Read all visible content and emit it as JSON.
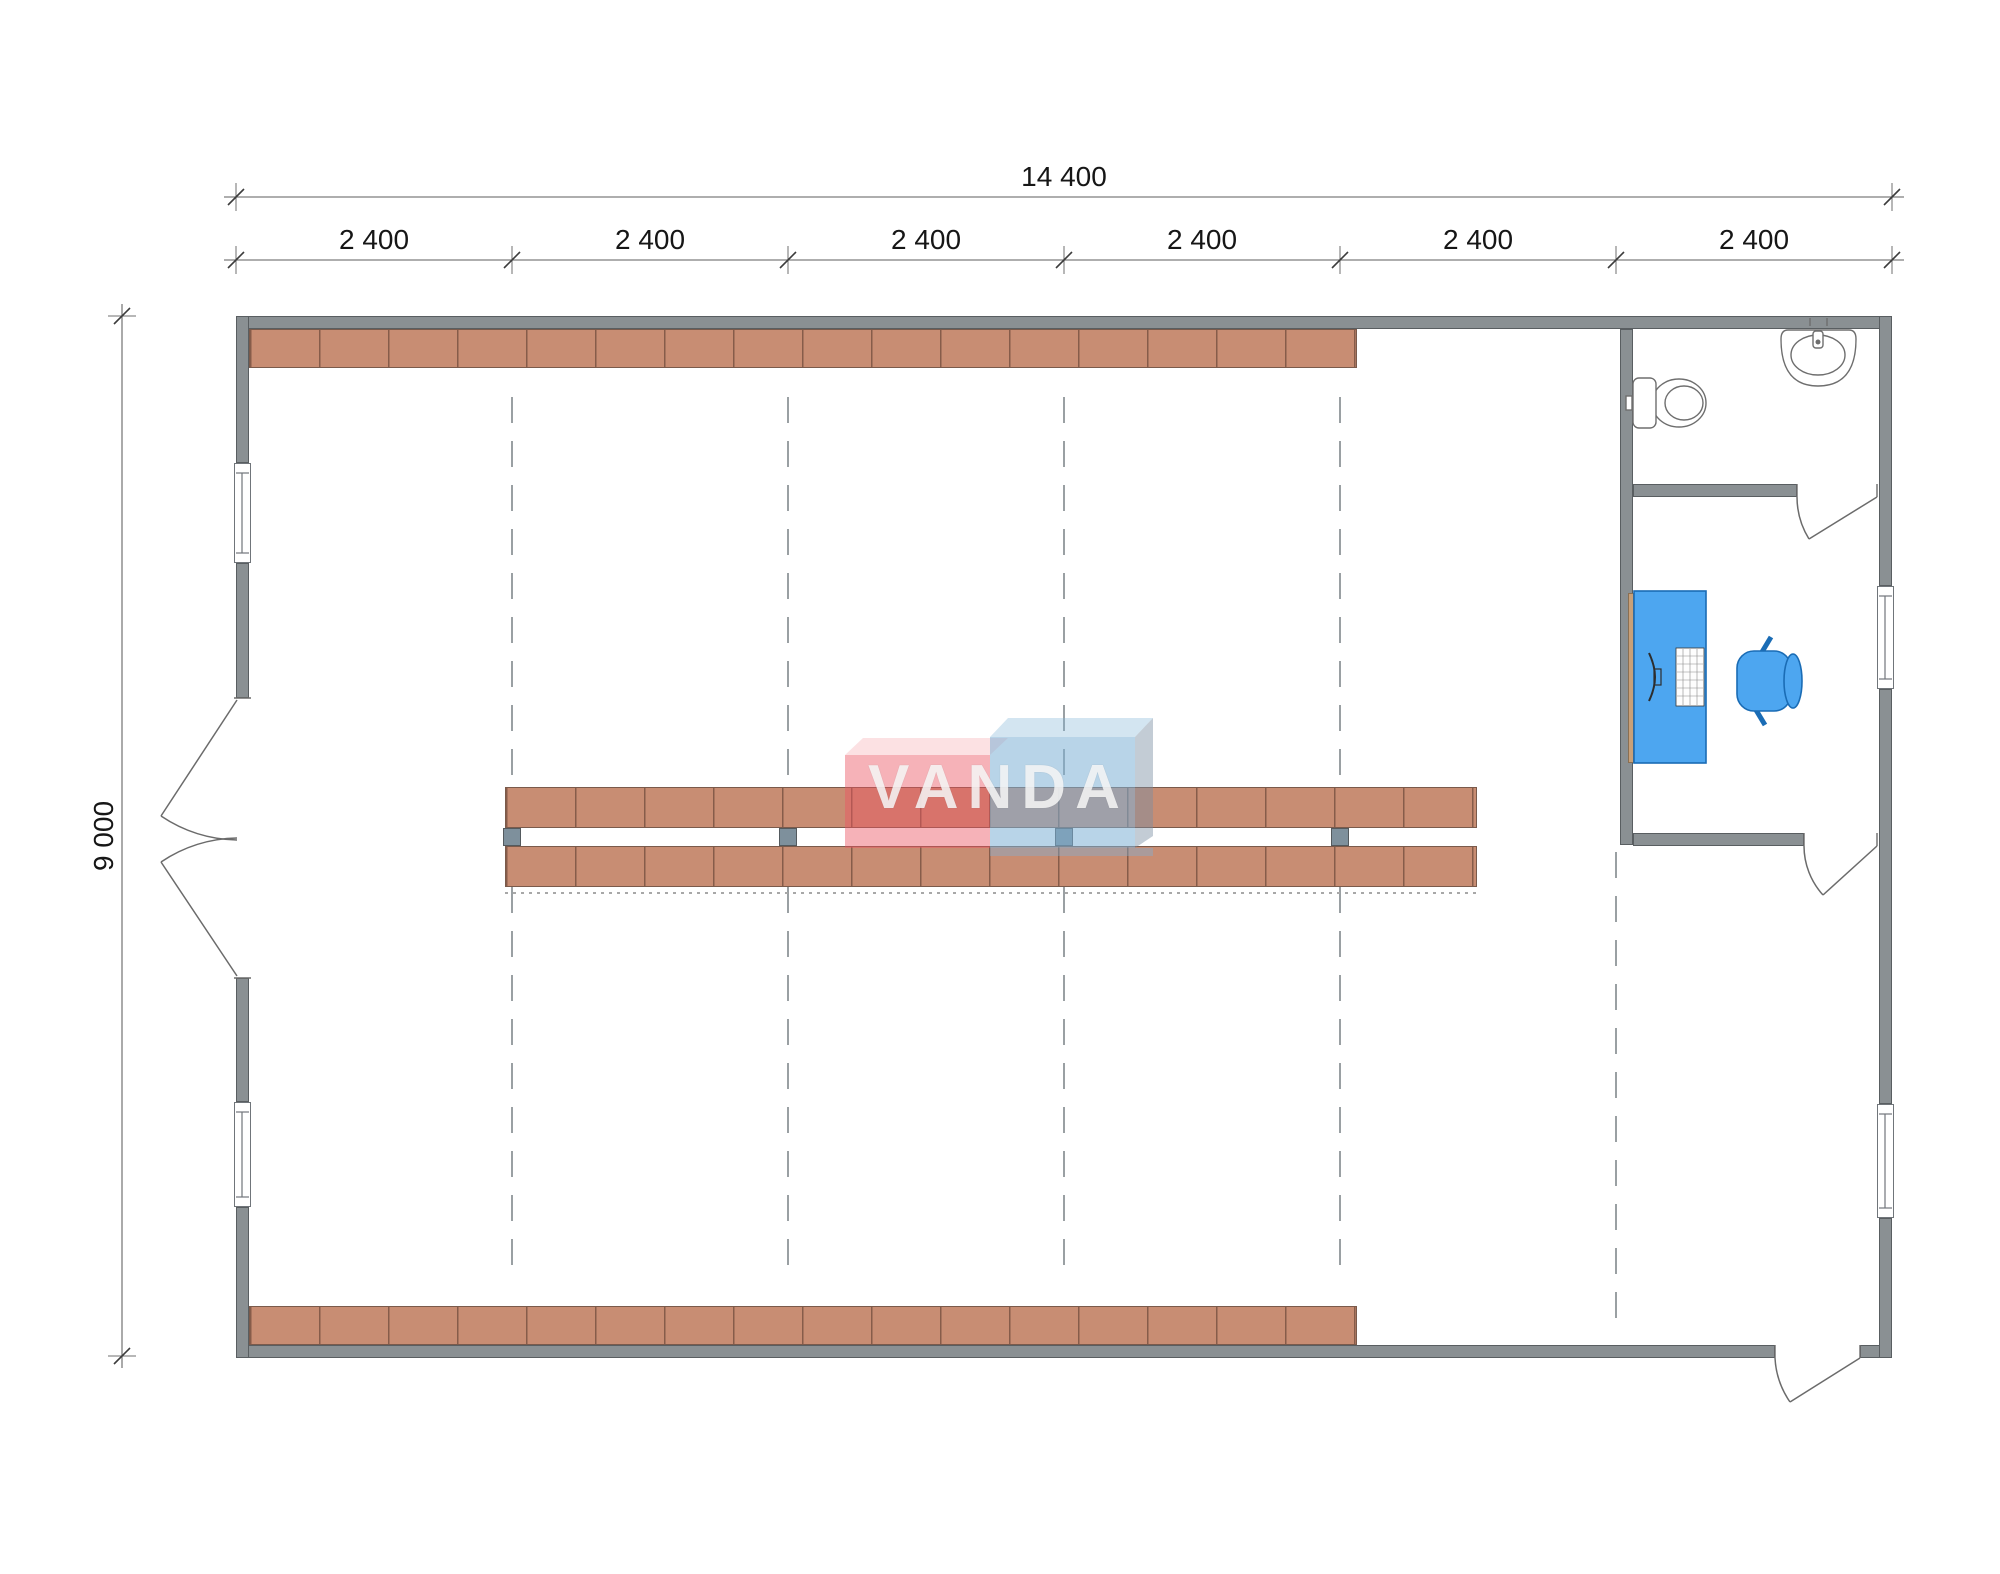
{
  "dimensions": {
    "total_width_label": "14 400",
    "segment_labels": [
      "2 400",
      "2 400",
      "2 400",
      "2 400",
      "2 400",
      "2 400"
    ],
    "total_height_label": "9 000"
  },
  "watermark": {
    "text": "VANDA",
    "red_block_color": "#ef5a66",
    "blue_block_color": "#9fc8e6"
  },
  "palette": {
    "wall": "#8a9093",
    "shelving": "#c88d73",
    "structural_column": "#7e909c",
    "furniture_blue": "#4da6f0",
    "desk_edge_tan": "#c8a078",
    "grid_dashed_line": "#9aa0a3",
    "dimension_text": "#161616"
  },
  "fixtures": {
    "bathroom": [
      "toilet",
      "sink"
    ],
    "office": [
      "desk",
      "computer-monitor",
      "keyboard",
      "office-chair"
    ]
  }
}
